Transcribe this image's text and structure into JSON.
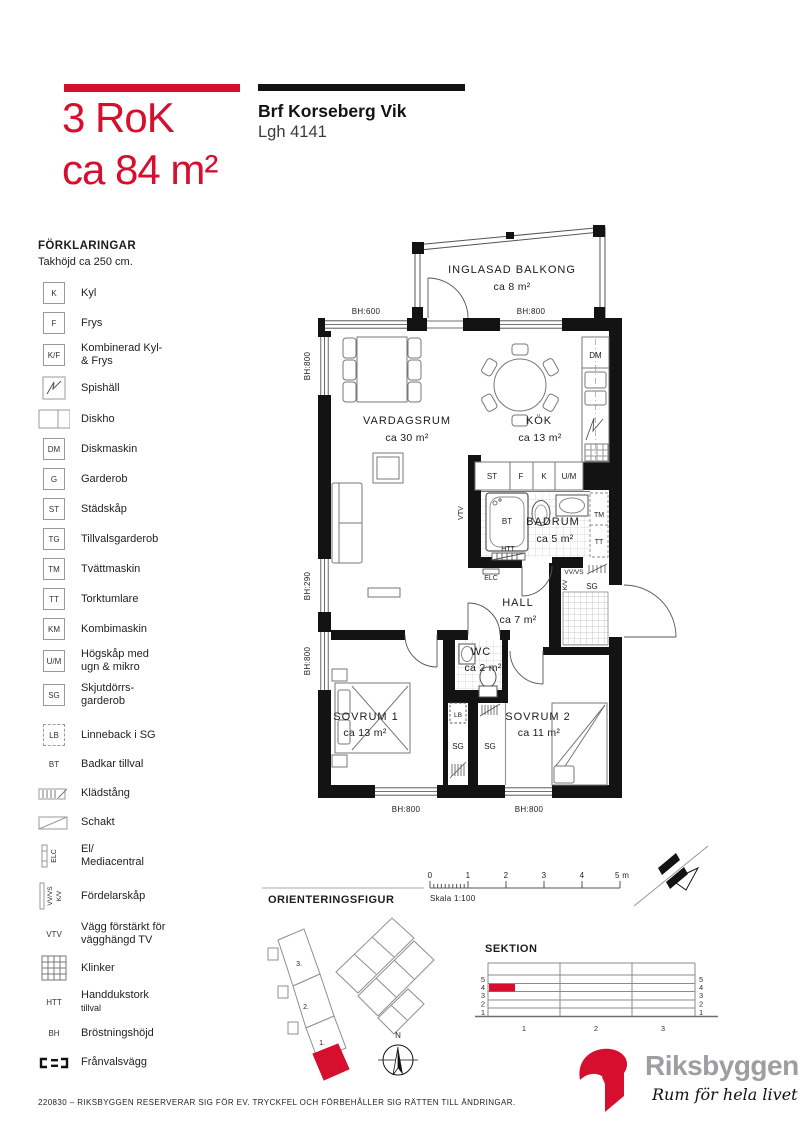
{
  "header": {
    "title_line1": "3 RoK",
    "title_line2": "ca 84 m²",
    "project": "Brf Korseberg Vik",
    "apartment": "Lgh 4141"
  },
  "colors": {
    "red": "#d60f2e",
    "black": "#131313",
    "gray": "#9c9ea1"
  },
  "legend": {
    "heading": "FÖRKLARINGAR",
    "subheading": "Takhöjd ca 250 cm.",
    "items": [
      {
        "sym": "K",
        "label": "Kyl"
      },
      {
        "sym": "F",
        "label": "Frys"
      },
      {
        "sym": "K/F",
        "label": "Kombinerad Kyl-",
        "label2": "& Frys"
      },
      {
        "sym": "",
        "label": "Spishäll"
      },
      {
        "sym": "",
        "label": "Diskho"
      },
      {
        "sym": "DM",
        "label": "Diskmaskin"
      },
      {
        "sym": "G",
        "label": "Garderob"
      },
      {
        "sym": "ST",
        "label": "Städskåp"
      },
      {
        "sym": "TG",
        "label": "Tillvalsgarderob"
      },
      {
        "sym": "TM",
        "label": "Tvättmaskin"
      },
      {
        "sym": "TT",
        "label": "Torktumlare"
      },
      {
        "sym": "KM",
        "label": "Kombimaskin"
      },
      {
        "sym": "U/M",
        "label": "Högskåp med",
        "label2": "ugn & mikro"
      },
      {
        "sym": "SG",
        "label": "Skjutdörrs-",
        "label2": "garderob"
      },
      {
        "sym": "LB",
        "label": "Linneback i SG"
      },
      {
        "sym": "BT",
        "label": "Badkar tillval"
      },
      {
        "sym": "",
        "label": "Klädstång"
      },
      {
        "sym": "",
        "label": "Schakt"
      },
      {
        "sym": "ELC",
        "label": "El/",
        "label2": "Mediacentral"
      },
      {
        "sym": "VV/VS",
        "sym2": "K/V",
        "label": "Fördelarskåp"
      },
      {
        "sym": "VTV",
        "label": "Vägg förstärkt för",
        "label2": "vägghängd TV"
      },
      {
        "sym": "",
        "label": "Klinker"
      },
      {
        "sym": "HTT",
        "label": "Handdukstork",
        "label2": "tillval"
      },
      {
        "sym": "BH",
        "label": "Bröstningshöjd"
      },
      {
        "sym": "",
        "label": "Frånvalsvägg"
      }
    ]
  },
  "plan": {
    "balcony_name": "INGLASAD BALKONG",
    "balcony_area": "ca 8 m²",
    "living_name": "VARDAGSRUM",
    "living_area": "ca 30 m²",
    "kitchen_name": "KÖK",
    "kitchen_area": "ca 13 m²",
    "bath_name": "BADRUM",
    "bath_area": "ca 5 m²",
    "hall_name": "HALL",
    "hall_area": "ca 7 m²",
    "wc_name": "WC",
    "wc_area": "ca 2 m²",
    "bed1_name": "SOVRUM 1",
    "bed1_area": "ca 13 m²",
    "bed2_name": "SOVRUM 2",
    "bed2_area": "ca 11 m²",
    "bh600": "BH:600",
    "bh800": "BH:800",
    "bh290": "BH:290",
    "dm": "DM",
    "st": "ST",
    "f": "F",
    "k": "K",
    "um": "U/M",
    "tm": "TM",
    "tt": "TT",
    "bt": "BT",
    "htt": "HTT",
    "elc": "ELC",
    "vtv": "VTV",
    "vvvs": "VV/VS",
    "kv": "K/V",
    "sg": "SG",
    "lb": "LB"
  },
  "scalebar": {
    "t0": "0",
    "t1": "1",
    "t2": "2",
    "t3": "3",
    "t4": "4",
    "t5": "5 m",
    "scale": "Skala 1:100"
  },
  "orientation": {
    "heading": "ORIENTERINGSFIGUR",
    "u3": "3.",
    "u2": "2.",
    "u1": "1.",
    "north": "N"
  },
  "sektion": {
    "heading": "SEKTION",
    "n5": "5",
    "n4": "4",
    "n3": "3",
    "n2": "2",
    "n1": "1",
    "c1": "1",
    "c2": "2",
    "c3": "3"
  },
  "logo": {
    "brand": "Riksbyggen",
    "tagline": "Rum för hela livet"
  },
  "footer": {
    "text": "220830 – RIKSBYGGEN RESERVERAR SIG FÖR EV. TRYCKFEL OCH FÖRBEHÅLLER SIG RÄTTEN TILL ÄNDRINGAR."
  }
}
